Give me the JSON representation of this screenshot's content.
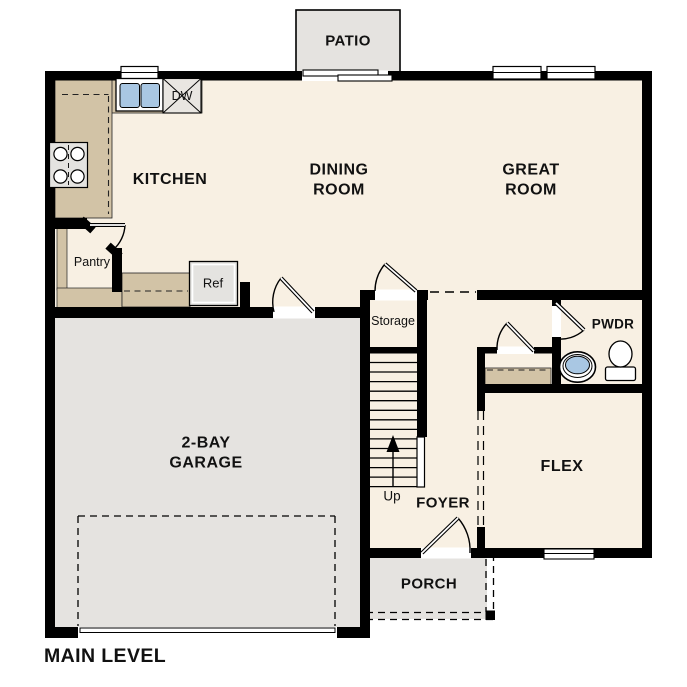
{
  "colors": {
    "floor": "#f8f0e3",
    "exterior_space": "#e5e3e0",
    "counter": "#d2c3a6",
    "water_blue": "#a9c7e3",
    "fixture_gray": "#e4e3e0",
    "wall": "#000000",
    "text": "#111111"
  },
  "rooms": {
    "patio": {
      "label": "PATIO"
    },
    "kitchen": {
      "label": "KITCHEN"
    },
    "dining_room": {
      "label_line1": "DINING",
      "label_line2": "ROOM"
    },
    "great_room": {
      "label_line1": "GREAT",
      "label_line2": "ROOM"
    },
    "garage": {
      "label_line1": "2-BAY",
      "label_line2": "GARAGE"
    },
    "flex": {
      "label": "FLEX"
    },
    "foyer": {
      "label": "FOYER"
    },
    "porch": {
      "label": "PORCH"
    },
    "powder_room": {
      "label": "PWDR"
    },
    "storage": {
      "label": "Storage"
    },
    "pantry": {
      "label": "Pantry"
    }
  },
  "fixtures": {
    "refrigerator": "Ref",
    "dishwasher": "DW",
    "stairs_direction": "Up"
  },
  "plan": {
    "level_title": "MAIN LEVEL"
  }
}
